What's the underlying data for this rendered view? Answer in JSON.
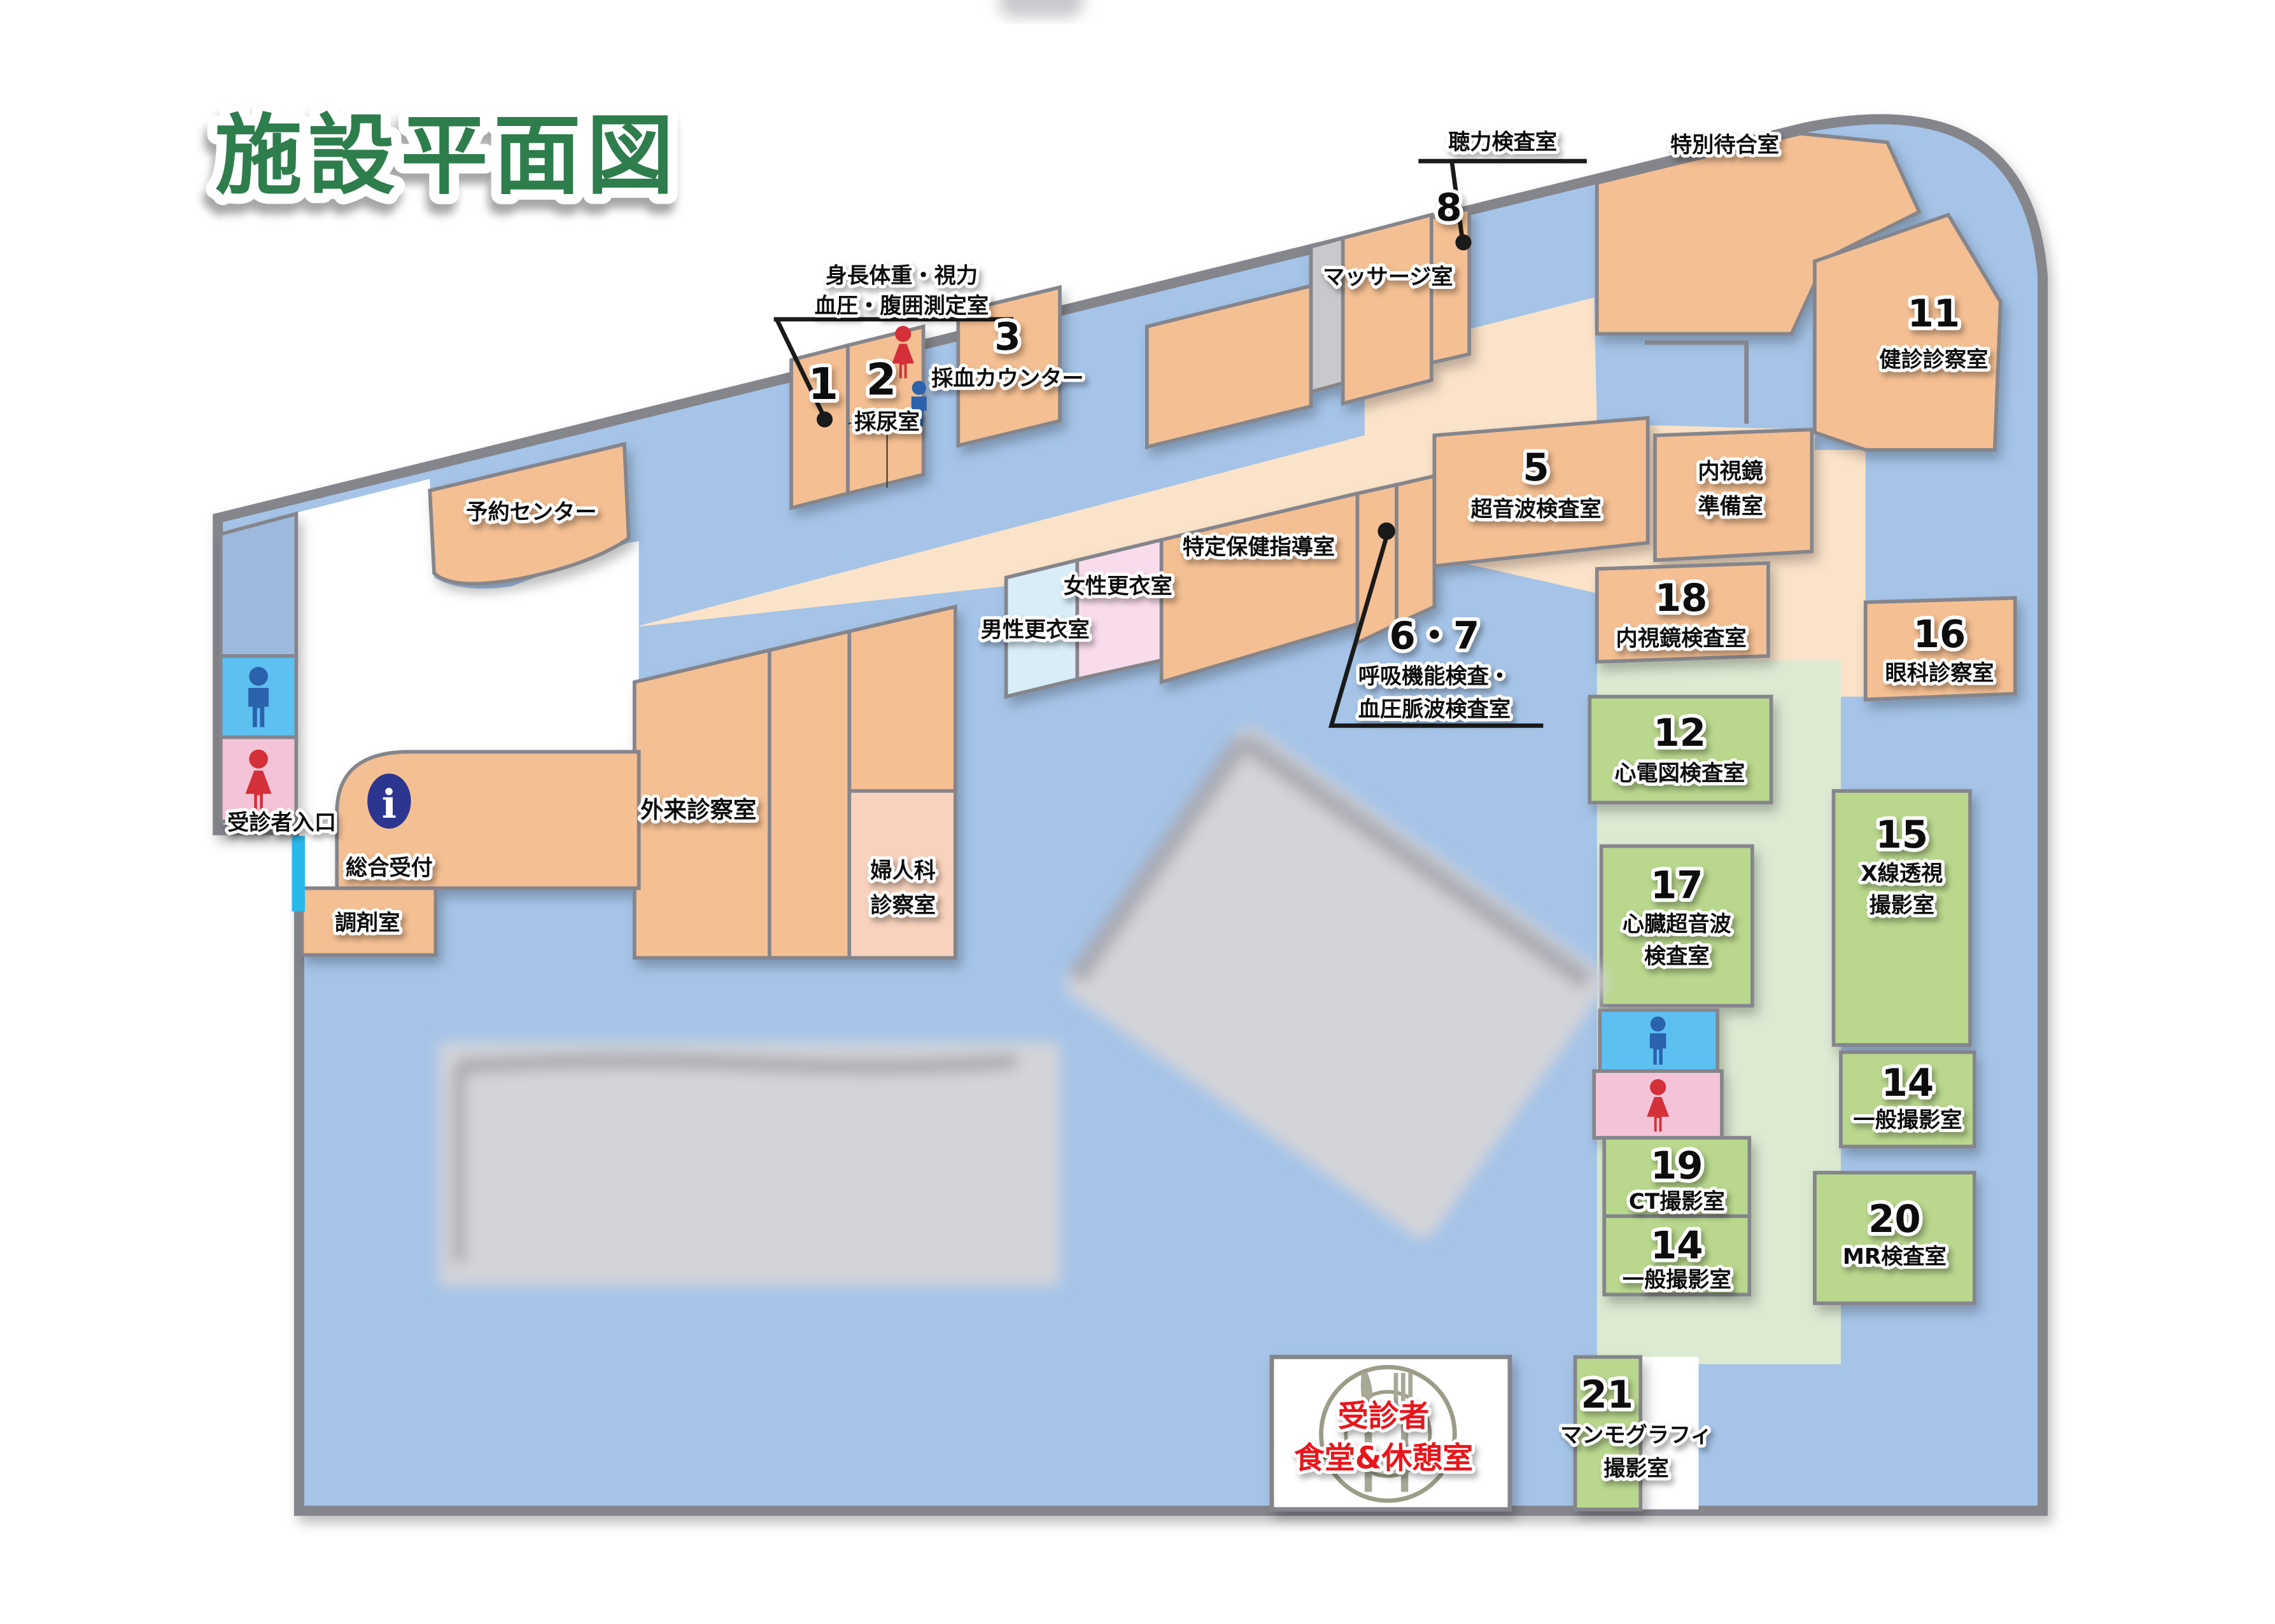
{
  "title": "施設平面図",
  "colors": {
    "wall_gray": "#85858c",
    "hall_blue": "#a5c4e8",
    "room_orange": "#f4bf92",
    "corridor_cream": "#fbe3c9",
    "room_green": "#b9d78d",
    "corridor_green": "#dcead2",
    "room_pink": "#f9dcec",
    "room_lightblue": "#d8edf8",
    "room_peach": "#f8d2bc",
    "toilet_blue": "#5bc0f0",
    "toilet_pink": "#f5c3d7",
    "strip_blue": "#9db9de",
    "elevator_gray": "#c9c9cd",
    "man_blue": "#2b62ac",
    "woman_red": "#d3303a",
    "info_blue": "#2c3590",
    "entrance_cyan": "#29b8ea",
    "title_green": "#2f7d4e",
    "dining_red": "#e8191c",
    "redaction_gray": "#d4d4d8"
  },
  "rooms": {
    "yoyaku": {
      "name": "予約センター"
    },
    "r1": {
      "num": "1"
    },
    "measure": {
      "l1": "身長体重・視力",
      "l2": "血圧・腹囲測定室"
    },
    "r2": {
      "num": "2",
      "name": "採尿室"
    },
    "r3": {
      "num": "3",
      "name": "採血カウンター"
    },
    "massage": {
      "name": "マッサージ室"
    },
    "r8": {
      "num": "8"
    },
    "hearing": {
      "name": "聴力検査室"
    },
    "wait": {
      "name": "特別待合室"
    },
    "r11": {
      "num": "11",
      "name": "健診診察室"
    },
    "prep": {
      "l1": "内視鏡",
      "l2": "準備室"
    },
    "r5": {
      "num": "5",
      "name": "超音波検査室"
    },
    "resp": {
      "num": "6・7",
      "l1": "呼吸機能検査・",
      "l2": "血圧脈波検査室"
    },
    "tokutei": {
      "name": "特定保健指導室"
    },
    "male": {
      "name": "男性更衣室"
    },
    "female": {
      "name": "女性更衣室"
    },
    "gairai": {
      "name": "外来診察室"
    },
    "fujinka": {
      "l1": "婦人科",
      "l2": "診察室"
    },
    "sogo": {
      "name": "総合受付"
    },
    "chozai": {
      "name": "調剤室"
    },
    "entrance": {
      "name": "受診者入口"
    },
    "r18": {
      "num": "18",
      "name": "内視鏡検査室"
    },
    "r16": {
      "num": "16",
      "name": "眼科診察室"
    },
    "r12": {
      "num": "12",
      "name": "心電図検査室"
    },
    "r15": {
      "num": "15",
      "l1": "X線透視",
      "l2": "撮影室"
    },
    "r17": {
      "num": "17",
      "l1": "心臓超音波",
      "l2": "検査室"
    },
    "r19": {
      "num": "19",
      "name": "CT撮影室"
    },
    "r14a": {
      "num": "14",
      "name": "一般撮影室"
    },
    "r14b": {
      "num": "14",
      "name": "一般撮影室"
    },
    "r20": {
      "num": "20",
      "name": "MR検査室"
    },
    "r21": {
      "num": "21",
      "l1": "マンモグラフィ",
      "l2": "撮影室"
    },
    "dining": {
      "l1": "受診者",
      "l2": "食堂&休憩室"
    }
  }
}
